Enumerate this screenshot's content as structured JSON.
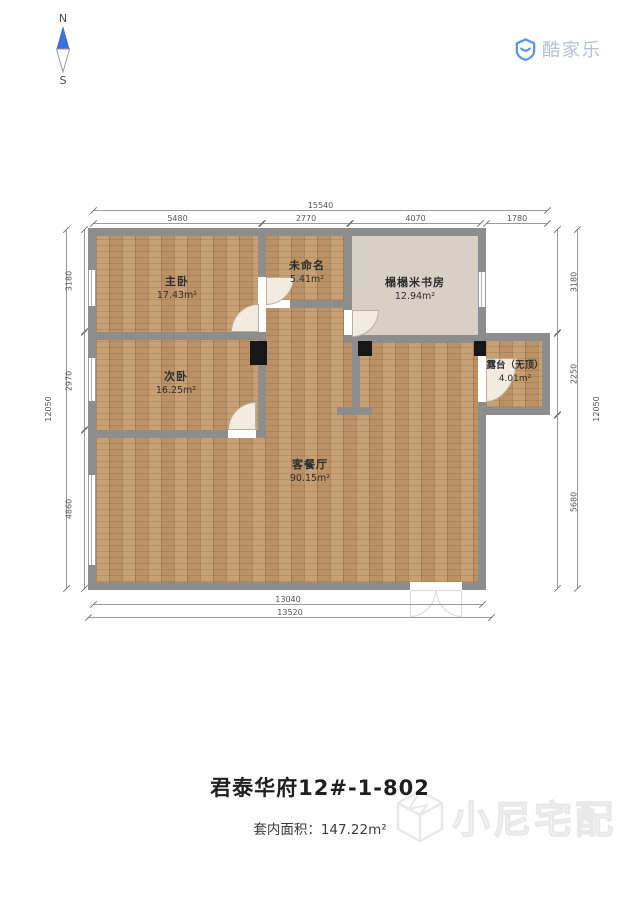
{
  "compass": {
    "north": "N",
    "south": "S"
  },
  "logo": {
    "text": "酷家乐"
  },
  "rooms": [
    {
      "name": "主卧",
      "area": "17.43m²"
    },
    {
      "name": "未命名",
      "area": "5.41m²"
    },
    {
      "name": "榻榻米书房",
      "area": "12.94m²"
    },
    {
      "name": "次卧",
      "area": "16.25m²"
    },
    {
      "name": "露台（无顶）",
      "area": "4.01m²"
    },
    {
      "name": "客餐厅",
      "area": "90.15m²"
    }
  ],
  "dimensions": {
    "top": {
      "overall": "15540",
      "segments": [
        "5480",
        "2770",
        "4070",
        "1780"
      ]
    },
    "left": {
      "overall": "12050",
      "segments": [
        "3180",
        "2970",
        "4860"
      ]
    },
    "right": {
      "overall": "12050",
      "segments": [
        "3180",
        "2250",
        "5680"
      ]
    },
    "bottom": {
      "inner": "13040",
      "outer": "13520"
    }
  },
  "footer": {
    "title": "君泰华府12#-1-802",
    "area_label": "套内面积：",
    "area_value": "147.22m²",
    "watermark": "小尼宅配"
  },
  "colors": {
    "accent_blue": "#3a70dd",
    "wall_gray": "#8d8d8d",
    "wood_floor": "#c49a6a",
    "study_floor": "#d7d0c4",
    "logo_text": "#b6c2d2"
  }
}
